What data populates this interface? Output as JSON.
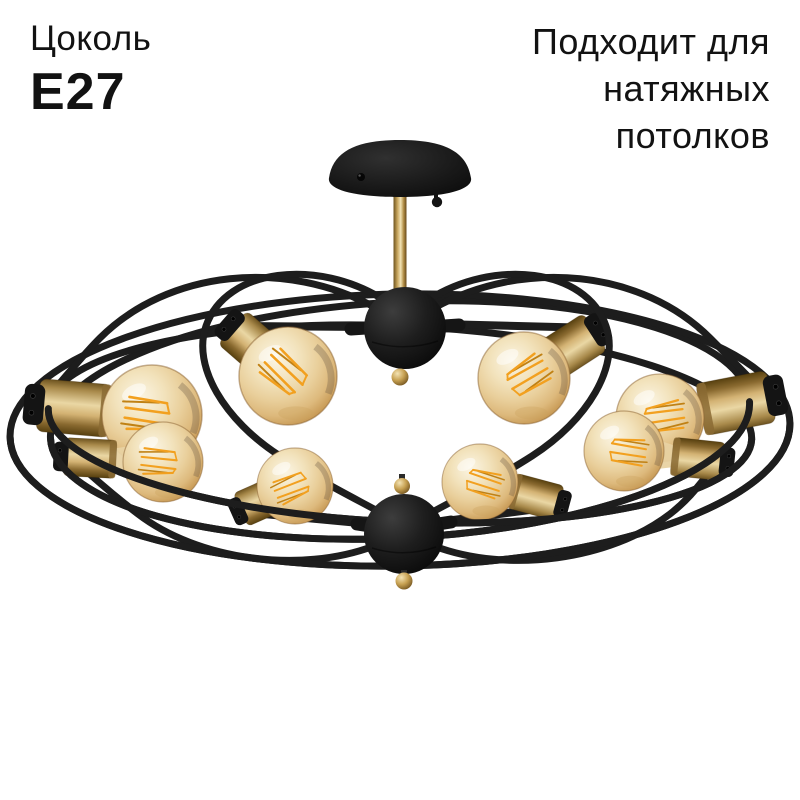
{
  "page": {
    "background_color": "#ffffff"
  },
  "overlays": {
    "socket": {
      "label": "Цоколь",
      "value": "E27"
    },
    "feature": {
      "lines": [
        "Подходит для",
        "натяжных",
        "потолков"
      ]
    }
  },
  "product": {
    "description": "Black wire-frame ceiling chandelier with brass sockets and amber globe filament bulbs",
    "bulb_count": 8,
    "palette": {
      "text": "#121212",
      "frame_black": "#1c1c1c",
      "brass": "#c9a65e",
      "bulb_glass": "#eed9ab",
      "filament": "#f2a01f",
      "background": "#ffffff"
    }
  }
}
